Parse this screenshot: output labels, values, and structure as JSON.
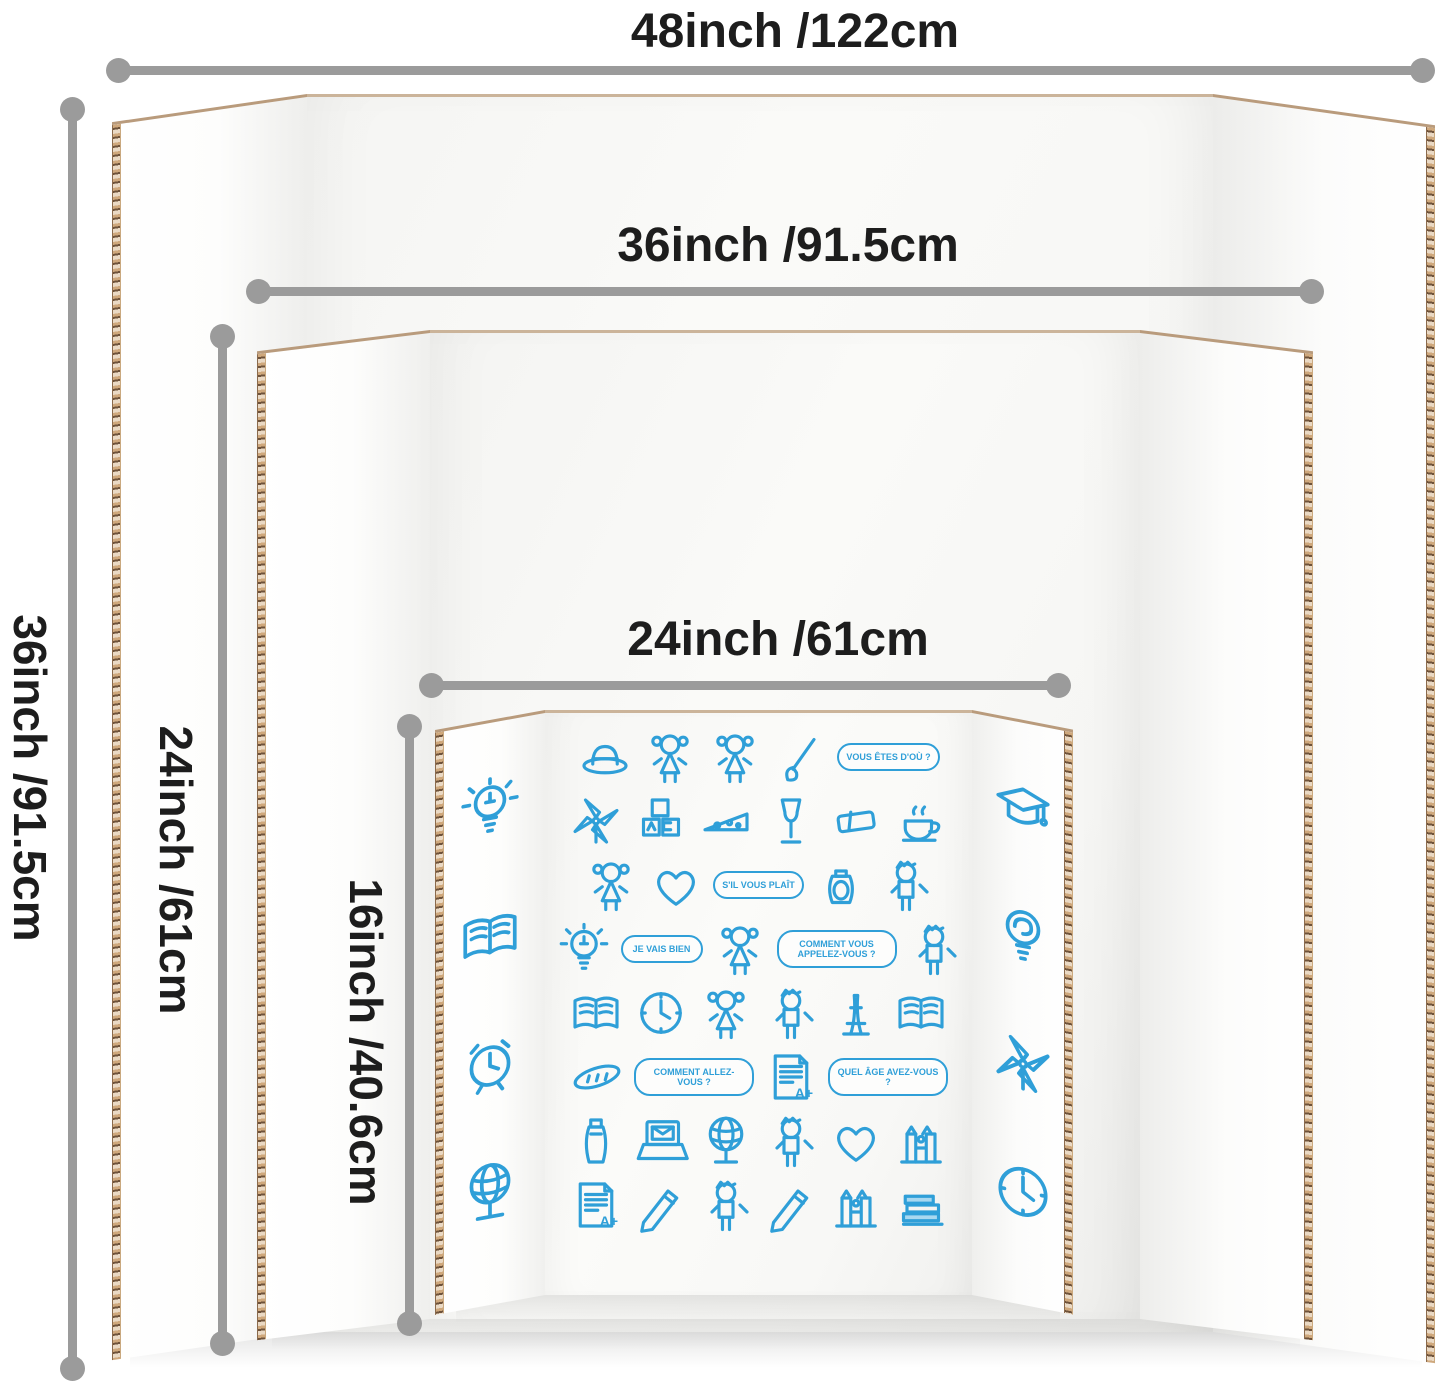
{
  "colors": {
    "dimension_gray": "#9b9b9b",
    "label_black": "#1d1d1d",
    "doodle_blue": "#2f9fd8",
    "cardboard_edge": "#b59473",
    "board_white": "#fbfbfa"
  },
  "dimension_labels": {
    "w48": "48inch /122cm",
    "w36": "36inch /91.5cm",
    "w24": "24inch /61cm",
    "h36": "36inch /91.5cm",
    "h24": "24inch /61cm",
    "h16": "16inch /40.6cm"
  },
  "doodles": {
    "left_flap": [
      {
        "t": "i",
        "i": "bulb-icon"
      },
      {
        "t": "i",
        "i": "open-book-icon"
      },
      {
        "t": "i",
        "i": "alarm-clock-icon"
      },
      {
        "t": "i",
        "i": "globe-icon"
      }
    ],
    "right_flap": [
      {
        "t": "i",
        "i": "graduation-cap-icon"
      },
      {
        "t": "i",
        "i": "brain-bulb-icon"
      },
      {
        "t": "i",
        "i": "pinwheel-icon"
      },
      {
        "t": "i",
        "i": "clock-icon"
      }
    ],
    "center": [
      {
        "t": "i",
        "i": "hat-icon"
      },
      {
        "t": "i",
        "i": "girl-icon"
      },
      {
        "t": "i",
        "i": "girl-icon"
      },
      {
        "t": "i",
        "i": "paintbrush-icon"
      },
      {
        "t": "b",
        "x": "VOUS ÊTES D'OÙ ?"
      },
      {
        "t": "i",
        "i": "pinwheel-icon"
      },
      {
        "t": "i",
        "i": "abc-blocks-icon"
      },
      {
        "t": "i",
        "i": "cheese-icon"
      },
      {
        "t": "i",
        "i": "wine-glass-icon"
      },
      {
        "t": "i",
        "i": "eraser-icon"
      },
      {
        "t": "i",
        "i": "teacup-icon"
      },
      {
        "t": "i",
        "i": "girl-icon"
      },
      {
        "t": "i",
        "i": "heart-icon"
      },
      {
        "t": "b",
        "x": "S'IL VOUS PLAÎT"
      },
      {
        "t": "i",
        "i": "jar-icon"
      },
      {
        "t": "i",
        "i": "boy-icon"
      },
      {
        "t": "i",
        "i": "bulb-icon"
      },
      {
        "t": "b",
        "x": "JE VAIS BIEN"
      },
      {
        "t": "i",
        "i": "girl-icon"
      },
      {
        "t": "b",
        "x": "COMMENT VOUS APPELEZ-VOUS ?"
      },
      {
        "t": "i",
        "i": "boy-icon"
      },
      {
        "t": "i",
        "i": "open-book-icon"
      },
      {
        "t": "i",
        "i": "clock-icon"
      },
      {
        "t": "i",
        "i": "girl-icon"
      },
      {
        "t": "i",
        "i": "boy-icon"
      },
      {
        "t": "i",
        "i": "eiffel-tower-icon"
      },
      {
        "t": "i",
        "i": "open-book-icon"
      },
      {
        "t": "i",
        "i": "baguette-icon"
      },
      {
        "t": "b",
        "x": "COMMENT ALLEZ-VOUS ?"
      },
      {
        "t": "p",
        "i": "paper-icon",
        "x": "A+"
      },
      {
        "t": "b",
        "x": "QUEL ÂGE AVEZ-VOUS ?"
      },
      {
        "t": "i",
        "i": "bottle-icon"
      },
      {
        "t": "i",
        "i": "laptop-mail-icon"
      },
      {
        "t": "i",
        "i": "globe-icon"
      },
      {
        "t": "i",
        "i": "boy-icon"
      },
      {
        "t": "i",
        "i": "heart-icon"
      },
      {
        "t": "i",
        "i": "cathedral-icon"
      },
      {
        "t": "p",
        "i": "paper-icon",
        "x": "A+"
      },
      {
        "t": "i",
        "i": "pencil-icon"
      },
      {
        "t": "i",
        "i": "boy-icon"
      },
      {
        "t": "i",
        "i": "pencil-icon"
      },
      {
        "t": "i",
        "i": "cathedral-icon"
      },
      {
        "t": "i",
        "i": "books-stack-icon"
      }
    ]
  }
}
